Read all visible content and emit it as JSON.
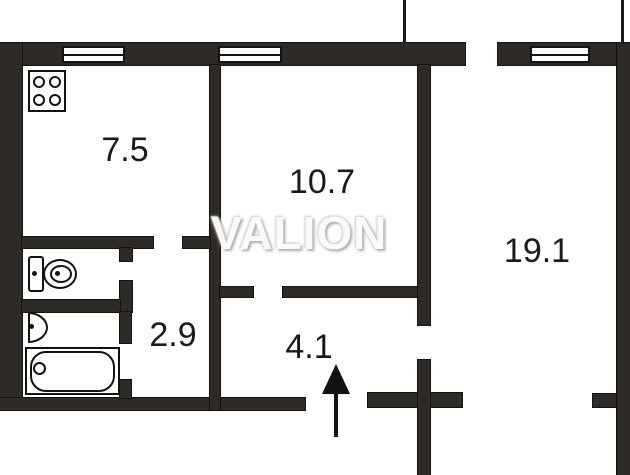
{
  "watermark": "VALION",
  "rooms": [
    {
      "id": "kitchen",
      "area": "7.5"
    },
    {
      "id": "living-room",
      "area": "10.7"
    },
    {
      "id": "hall-corridor",
      "area": "2.9"
    },
    {
      "id": "entrance-hall",
      "area": "4.1"
    },
    {
      "id": "bedroom",
      "area": "19.1"
    }
  ],
  "icons": [
    "stove-icon",
    "toilet-icon",
    "sink-icon",
    "bathtub-icon",
    "window-icon",
    "entrance-arrow-icon"
  ],
  "colors": {
    "wall": "#2e2a26",
    "line": "#141210",
    "background": "#ffffff",
    "label": "#1a1a1a",
    "watermark": "#fbfaf8",
    "watermark_shadow": "#b5b3af"
  }
}
